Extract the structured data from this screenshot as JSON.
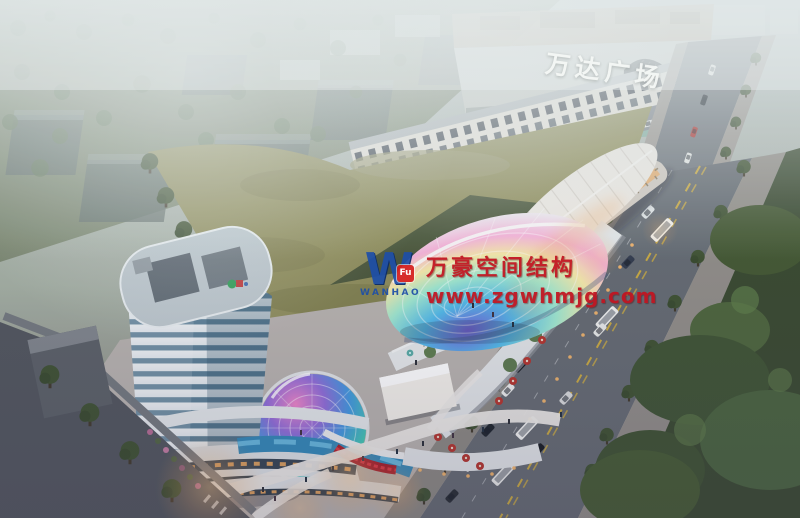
{
  "signage": {
    "mall_sign": "万达广场"
  },
  "watermark": {
    "logo_letter": "W",
    "logo_badge": "Fu",
    "logo_name": "WANHAO",
    "title": "万豪空间结构",
    "url": "www.zgwhmjg.com"
  },
  "colors": {
    "wm_red": "#c21420",
    "wm_blue": "#1e4fa8",
    "wm_badge_bg": "#d62020",
    "sign_white": "#f5f8f6",
    "field_green": "#8d8b57",
    "park_green": "#36462c",
    "road_gray": "#62686f",
    "tower_band_white": "#edf1f3",
    "tower_glass_teal": "#587d94",
    "warm_glow": "#f0a85c",
    "shell_pink": "#f6b2d8",
    "dome_purple": "#8f6ad8",
    "umbrella_red": "#b33029"
  }
}
